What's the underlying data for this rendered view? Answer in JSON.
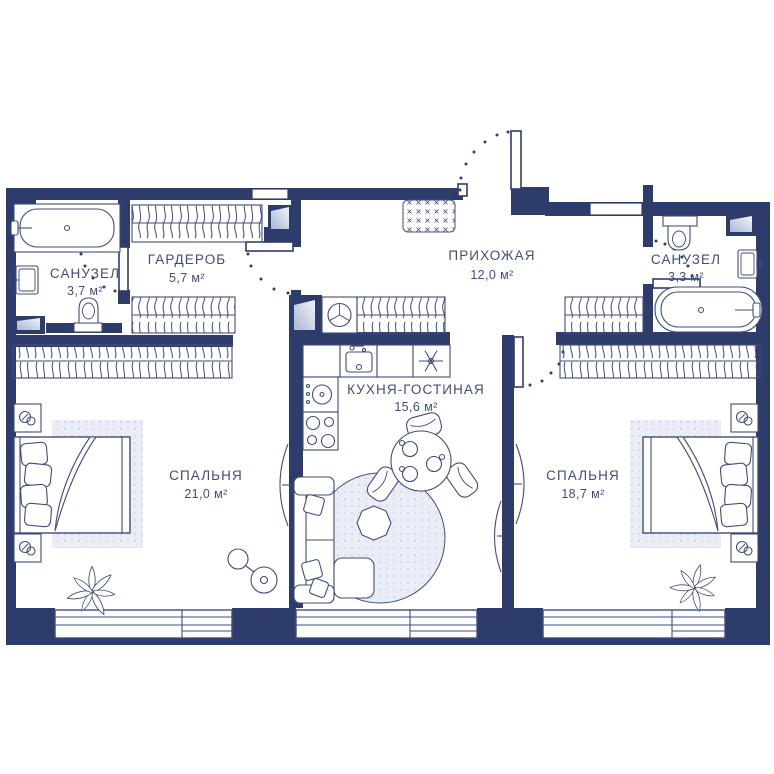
{
  "plan": {
    "rooms": [
      {
        "name": "САНУЗЕЛ",
        "area": "3,7 м²"
      },
      {
        "name": "ГАРДЕРОБ",
        "area": "5,7 м²"
      },
      {
        "name": "ПРИХОЖАЯ",
        "area": "12,0 м²"
      },
      {
        "name": "САНУЗЕЛ",
        "area": "3,3 м²"
      },
      {
        "name": "СПАЛЬНЯ",
        "area": "21,0 м²"
      },
      {
        "name": "КУХНЯ-ГОСТИНАЯ",
        "area": "15,6 м²"
      },
      {
        "name": "СПАЛЬНЯ",
        "area": "18,7 м²"
      }
    ],
    "colors": {
      "wall": "#2e3c6b",
      "furniture_line": "#3f4d7d",
      "text": "#3f4d7d",
      "light_fill": "#e9ecf4",
      "background": "#ffffff"
    }
  }
}
